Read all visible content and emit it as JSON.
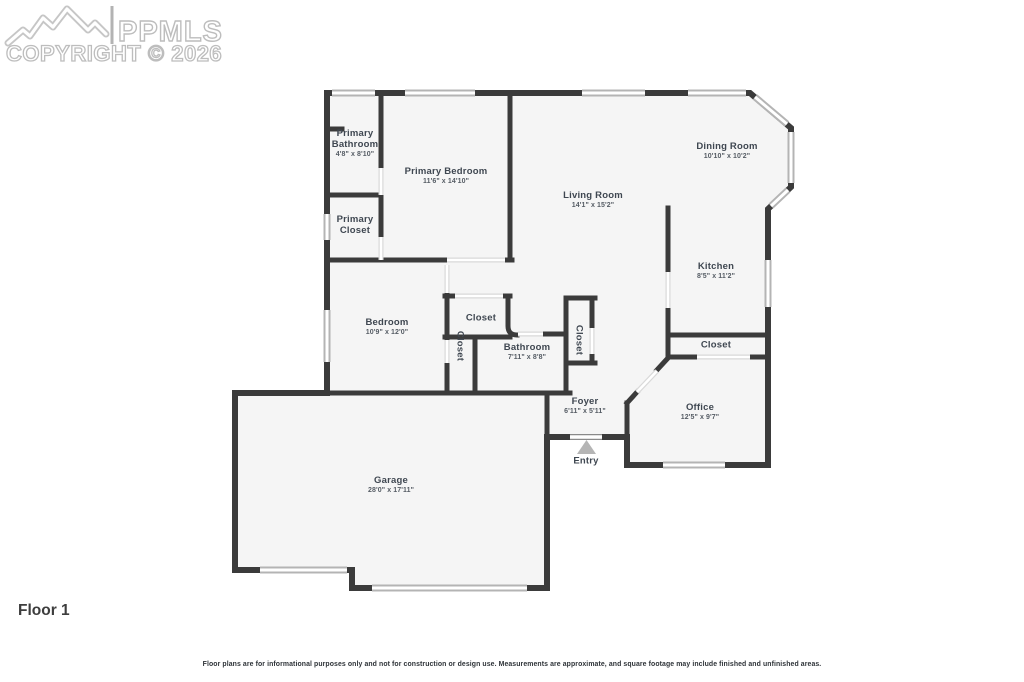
{
  "header": {
    "brand": "PPMLS",
    "copyright": "COPYRIGHT © 2026"
  },
  "floor": {
    "label": "Floor 1"
  },
  "footer": {
    "disclaimer": "Floor plans are for informational purposes only and not for construction or design use. Measurements are approximate, and square footage may include finished and unfinished areas."
  },
  "entry": {
    "label": "Entry"
  },
  "rooms": {
    "primary_bathroom": {
      "name": "Primary Bathroom",
      "dims": "4'8\" x 8'10\""
    },
    "primary_bedroom": {
      "name": "Primary Bedroom",
      "dims": "11'6\" x 14'10\""
    },
    "primary_closet": {
      "name": "Primary Closet"
    },
    "living_room": {
      "name": "Living Room",
      "dims": "14'1\" x 15'2\""
    },
    "dining_room": {
      "name": "Dining Room",
      "dims": "10'10\" x 10'2\""
    },
    "kitchen": {
      "name": "Kitchen",
      "dims": "8'5\" x 11'2\""
    },
    "kitchen_closet": {
      "name": "Closet"
    },
    "bedroom": {
      "name": "Bedroom",
      "dims": "10'9\" x 12'0\""
    },
    "hall_closet": {
      "name": "Closet"
    },
    "bedroom_closet": {
      "name": "Closet"
    },
    "bathroom": {
      "name": "Bathroom",
      "dims": "7'11\" x 8'8\""
    },
    "foyer_closet": {
      "name": "Closet"
    },
    "foyer": {
      "name": "Foyer",
      "dims": "6'11\" x 5'11\""
    },
    "office": {
      "name": "Office",
      "dims": "12'5\" x 9'7\""
    },
    "garage": {
      "name": "Garage",
      "dims": "28'0\" x 17'11\""
    }
  },
  "colors": {
    "wall": "#3b3b3b",
    "room_fill": "#f5f5f5",
    "label_text": "#3f4751",
    "window_edge": "#b4b4b4",
    "door_edge": "#d9d9d9",
    "entry_arrow": "#b5b5b5",
    "watermark": "#c4c4c4"
  }
}
